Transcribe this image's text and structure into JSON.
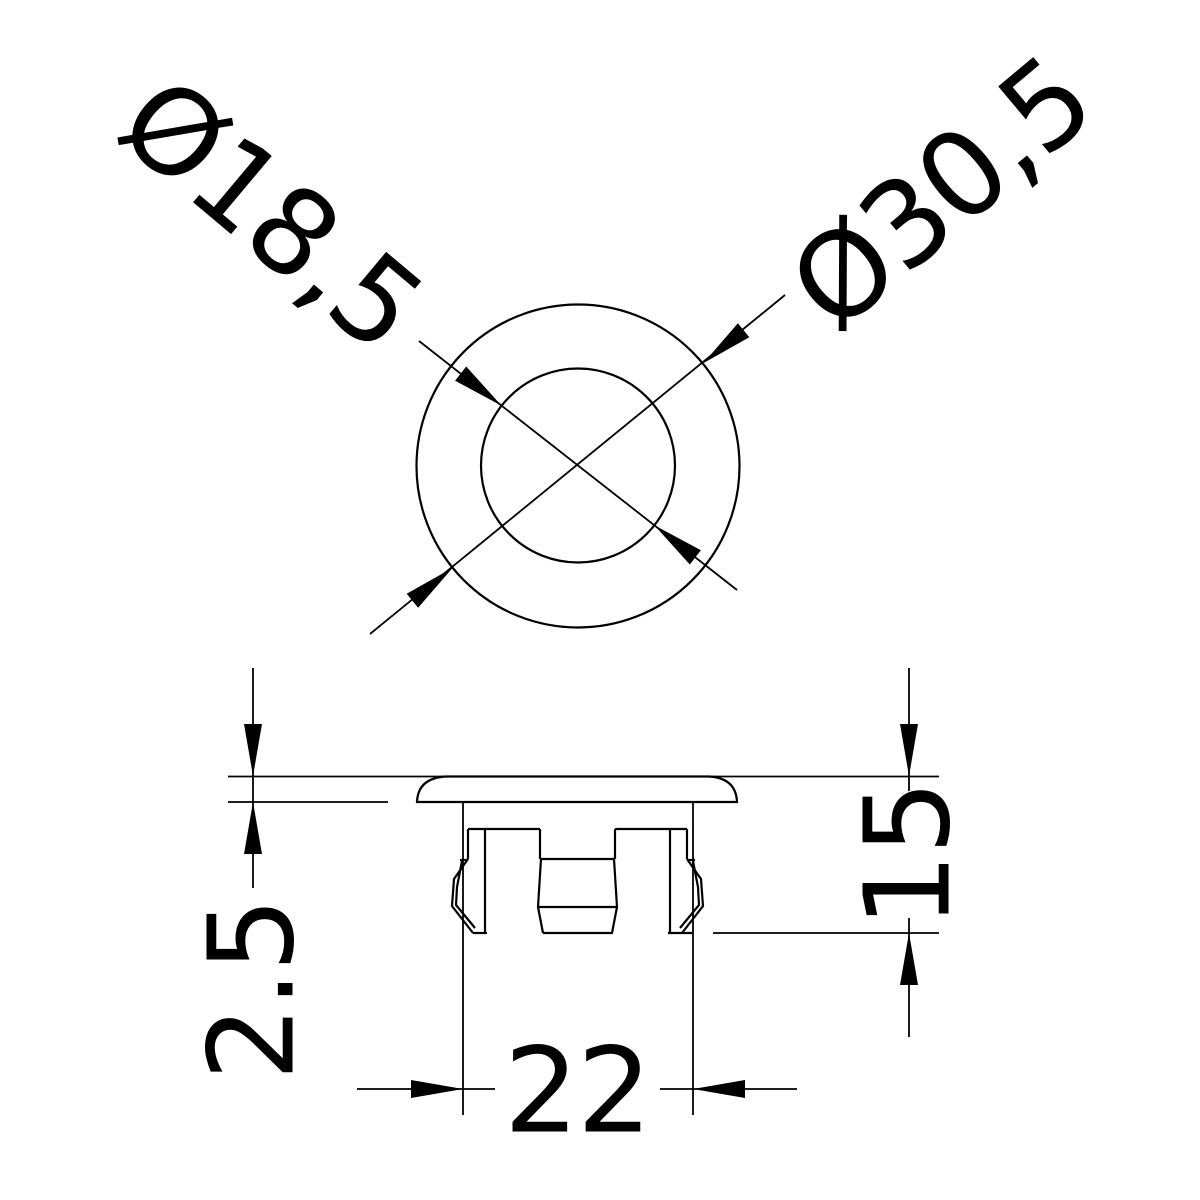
{
  "drawing": {
    "background_color": "#ffffff",
    "line_color": "#000000"
  },
  "top_view": {
    "inner_diameter": {
      "label": "Ø18,5",
      "value": 18.5
    },
    "outer_diameter": {
      "label": "Ø30,5",
      "value": 30.5
    }
  },
  "side_view": {
    "cap_height": {
      "label": "2.5",
      "value": 2.5
    },
    "total_height": {
      "label": "15",
      "value": 15
    },
    "body_width": {
      "label": "22",
      "value": 22
    }
  }
}
